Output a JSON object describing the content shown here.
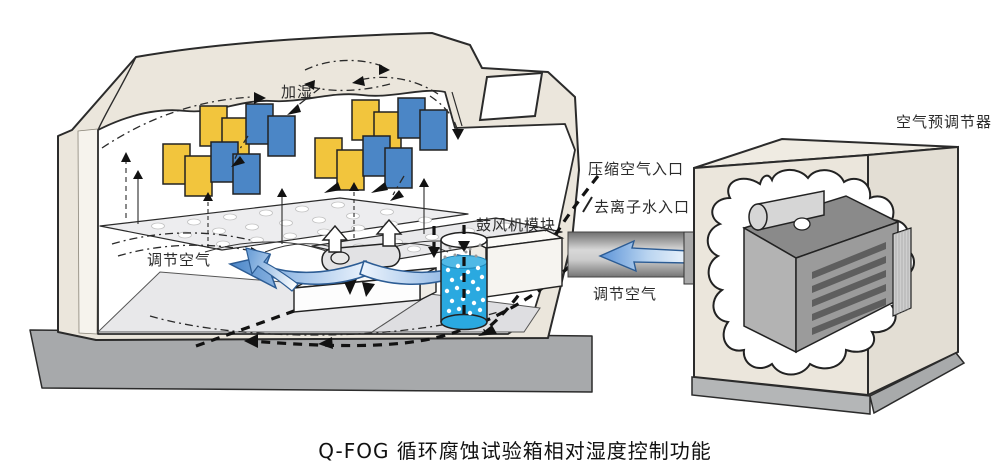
{
  "caption": "Q-FOG 循环腐蚀试验箱相对湿度控制功能",
  "labels": {
    "humidify": "加湿",
    "conditioned_air_chamber": "调节空气",
    "blower_module": "鼓风机模块",
    "compressed_air_inlet": "压缩空气入口",
    "deionized_water_inlet": "去离子水入口",
    "conditioned_air_duct": "调节空气",
    "air_preconditioner": "空气预调节器"
  },
  "colors": {
    "sample_panel_yellow": "#F2C53D",
    "sample_panel_blue": "#4B86C6",
    "water_blue": "#2AA9E0",
    "flow_arrow_blue": "#4A86C8",
    "cabinet_beige": "#EBE6DC",
    "base_gray": "#A7A9AB",
    "duct_gray": "#8E8E8E",
    "machine_gray": "#9B9B9B"
  }
}
